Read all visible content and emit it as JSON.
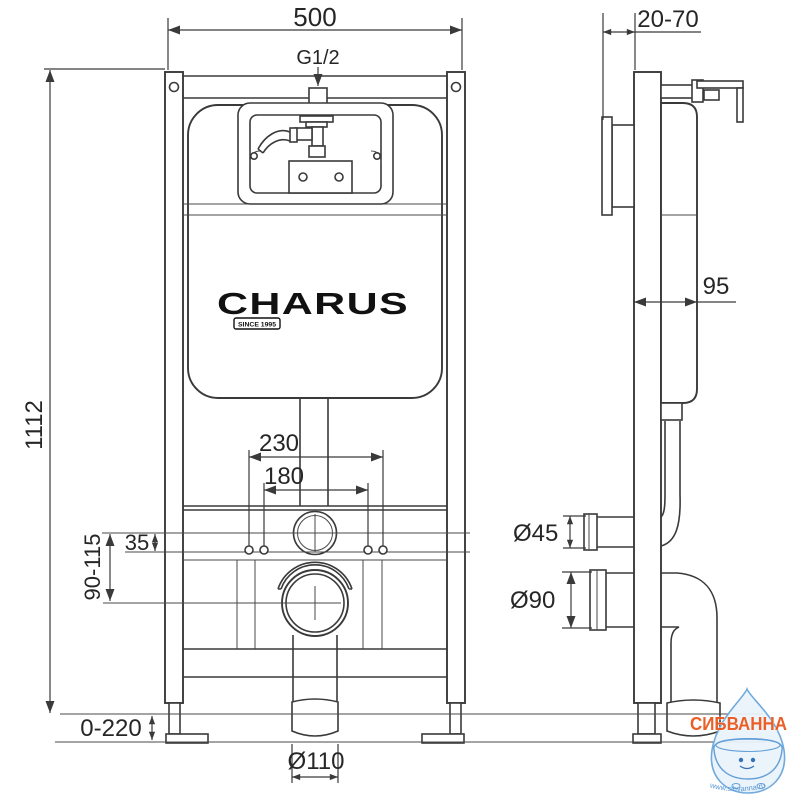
{
  "page": {
    "title": "CHARUS concealed cistern installation frame — dimensional drawing"
  },
  "brand": {
    "logo": "CHARUS",
    "tagline": "SINCE 1995"
  },
  "dims": {
    "frame_width": "500",
    "water_inlet": "G1/2",
    "frame_height": "1112",
    "wall_offset": "20-70",
    "frame_depth": "95",
    "stud_spacing_outer": "230",
    "stud_spacing_inner": "180",
    "flush_to_studs": "35",
    "flush_to_waste": "90-115",
    "foot_adjust": "0-220",
    "flush_pipe_dia": "Ø45",
    "waste_pipe_dia": "Ø90",
    "outlet_dia": "Ø110"
  },
  "watermark": {
    "name": "СИБВАННА",
    "site": "www.sibvanna.ru"
  },
  "colors": {
    "line": "#3a3a3a",
    "watermark_orange": "#e8571c",
    "watermark_blue": "#5b9bd5",
    "watermark_drop_fill": "#eaf3fb"
  }
}
